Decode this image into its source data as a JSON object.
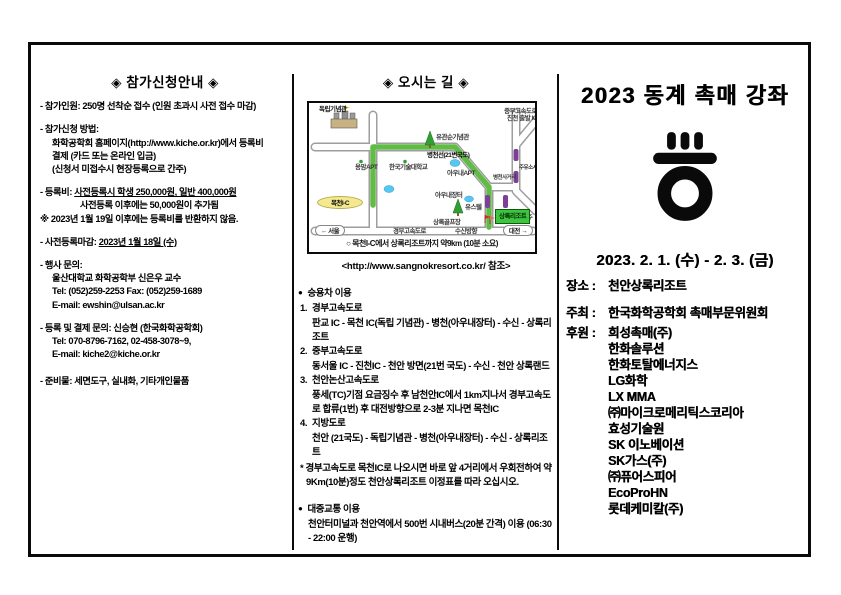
{
  "colors": {
    "route_green": "#62bb46",
    "resort_green": "#3ec43e",
    "ic_yellow": "#f4e98e",
    "overpass_purple": "#7d3f98",
    "water_blue": "#57c7ef",
    "tree_green": "#2f9e33"
  },
  "left": {
    "title": "◈ 참가신청안내 ◈",
    "capacity": "- 참가인원: 250명 선착순 접수 (인원 초과시 사전 접수 마감)",
    "method_head": "- 참가신청 방법:",
    "method_l1": "화학공학회 홈페이지(http://www.kiche.or.kr)에서 등록비",
    "method_l2": "결제 (카드 또는 온라인 입금)",
    "method_l3": "(신청서 미접수시 현장등록으로 간주)",
    "fee_head": "- 등록비: ",
    "fee_underline": "사전등록시 학생 250,000원, 일반 400,000원",
    "fee_l2": "사전등록 이후에는 50,000원이 추가됨",
    "fee_l3": "※ 2023년 1월 19일 이후에는 등록비를 반환하지 않음.",
    "deadline_head": "- 사전등록마감: ",
    "deadline_value": "2023년 1월 18일 (수)",
    "contact_head": "- 행사 문의:",
    "contact_l1": "울산대학교 화학공학부 신은우 교수",
    "contact_l2": "Tel: (052)259-2253   Fax: (052)259-1689",
    "contact_l3": "E-mail: ewshin@ulsan.ac.kr",
    "pay_head": "- 등록 및 결제 문의: 신승현 (한국화학공학회)",
    "pay_l1": "Tel: 070-8796-7162, 02-458-3078~9,",
    "pay_l2": "E-mail: kiche2@kiche.or.kr",
    "items_head": "- 준비물: 세면도구, 실내화, 기타개인물품"
  },
  "middle": {
    "title": "◈ 오시는 길 ◈",
    "bullet": "●",
    "map": {
      "caption": "○ 목천I-C에서 상록리조트까지 약9km (10분 소요)",
      "labels": {
        "memorial_hall": "독립기념관",
        "mokcheon_ic": "목천I-C",
        "road21": "병천선(21번국도)",
        "yongam_apt": "용암APT",
        "kut_univ": "한국기술대학교",
        "yugwansun": "유관순기념관",
        "aunae_apt": "아우내APT",
        "byeongcheon_jct": "병천사거리",
        "aunae_market": "아우내장터",
        "youth_hostel": "유스텔",
        "golf": "상록골프장",
        "resort": "상록리조트",
        "jungbu_hwy": "중부고속도로",
        "jincheon_ic": "진천 출발 IC",
        "gas": "주유소시설",
        "ochang": "오창/청주",
        "seoul": "← 서울",
        "gyeongbu_hwy": "경부고속도로",
        "susin": "수신방향",
        "daejeon": "대전 →"
      }
    },
    "url_note": "<http://www.sangnokresort.co.kr/ 참조>",
    "car_head": "승용차 이용",
    "routes": [
      {
        "no": "1.",
        "name": "경부고속도로",
        "desc": "판교 IC - 목천 IC(독립 기념관) - 병천(아우내장터) - 수신 - 상록리조트"
      },
      {
        "no": "2.",
        "name": "중부고속도로",
        "desc": "동서울 IC - 진천IC - 천안 방면(21번 국도) - 수신 - 천안 상록랜드"
      },
      {
        "no": "3.",
        "name": "천안논산고속도로",
        "desc": "풍세(TC)기점 요금징수 후 남천안IC에서 1km지나서 경부고속도로 합류(1번) 후 대전방향으로 2-3분 지나면 목천IC"
      },
      {
        "no": "4.",
        "name": "지방도로",
        "desc": "천안 (21국도) - 독립기념관 - 병천(아우내장터) - 수신 - 상록리조트"
      }
    ],
    "note": "* 경부고속도로 목천IC로 나오시면 바로 앞 4거리에서 우회전하여 약 9Km(10분)정도 천안상록리조트 이정표를 따라 오십시오.",
    "transit_head": "대중교통 이용",
    "transit_body": "천안터미널과 천안역에서 500번 시내버스(20분 간격) 이용 (06:30 - 22:00 운행)"
  },
  "right": {
    "title": "2023 동계 촉매 강좌",
    "date": "2023. 2. 1. (수) - 2. 3. (금)",
    "place_label": "장소 :",
    "place": "천안상록리조트",
    "host_label": "주최 :",
    "host": "한국화학공학회 촉매부문위원회",
    "sponsor_label": "후원 :",
    "sponsors": [
      "희성촉매(주)",
      "한화솔루션",
      "한화토탈에너지스",
      "LG화학",
      "LX MMA",
      "㈜마이크로메리틱스코리아",
      "효성기술원",
      "SK 이노베이션",
      "SK가스(주)",
      "㈜퓨어스피어",
      "EcoProHN",
      "롯데케미칼(주)"
    ]
  }
}
